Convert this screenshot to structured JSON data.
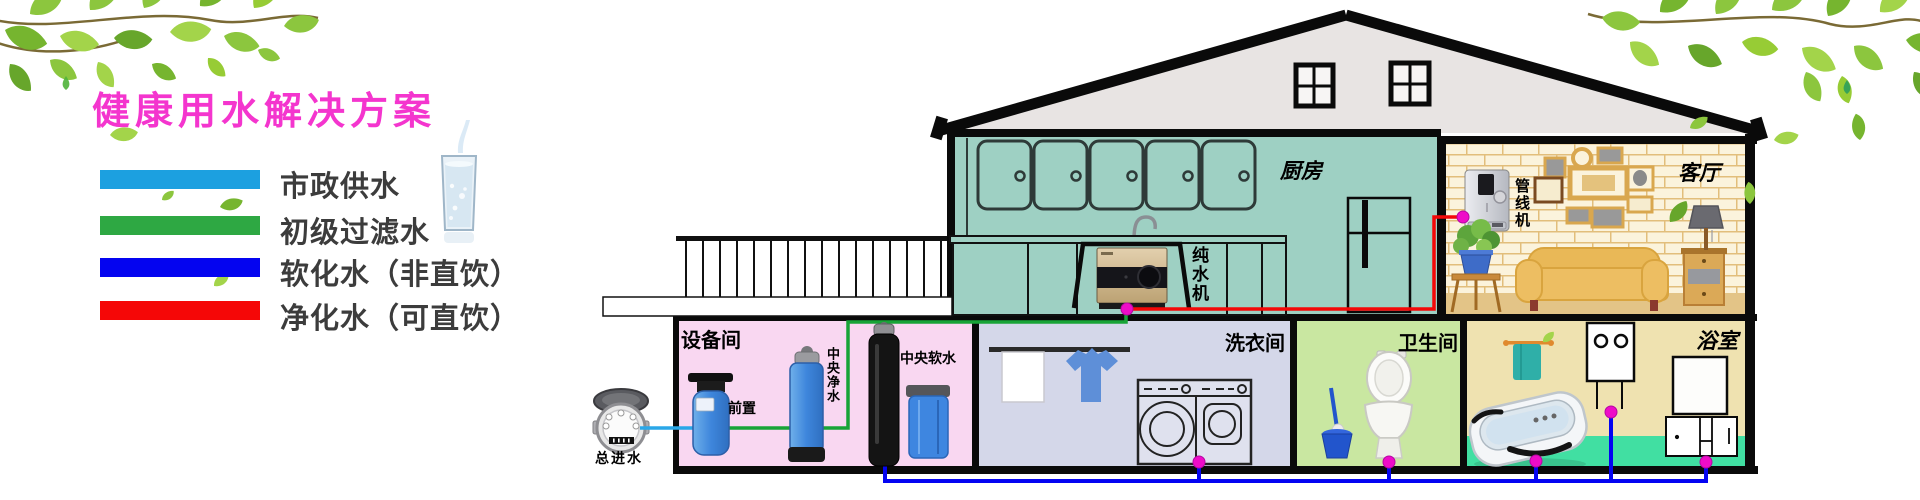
{
  "title": "健康用水解决方案",
  "legend": {
    "items": [
      {
        "label": "市政供水",
        "color": "#1CA0E0"
      },
      {
        "label": "初级过滤水",
        "color": "#2EA843"
      },
      {
        "label": "软化水（非直饮）",
        "color": "#0404F0"
      },
      {
        "label": "净化水（可直饮）",
        "color": "#F50707"
      }
    ]
  },
  "house": {
    "rooms": {
      "kitchen": "厨房",
      "living_room": "客厅",
      "equipment_room": "设备间",
      "laundry_room": "洗衣间",
      "toilet_room": "卫生间",
      "bath_room": "浴室"
    },
    "equipment": {
      "main_inlet": "总进水",
      "prefilter": "前置",
      "central_purifier": "中央净水",
      "central_softener": "中央软水",
      "pure_water_machine": "纯水机",
      "pipeline_machine": "管线机"
    }
  },
  "colors": {
    "title": "#F435CE",
    "pipe_municipal": "#2AA7E8",
    "pipe_filtered": "#18A437",
    "pipe_softened": "#0404F2",
    "pipe_purified": "#F40808",
    "junction_dot": "#EE0CC8"
  }
}
